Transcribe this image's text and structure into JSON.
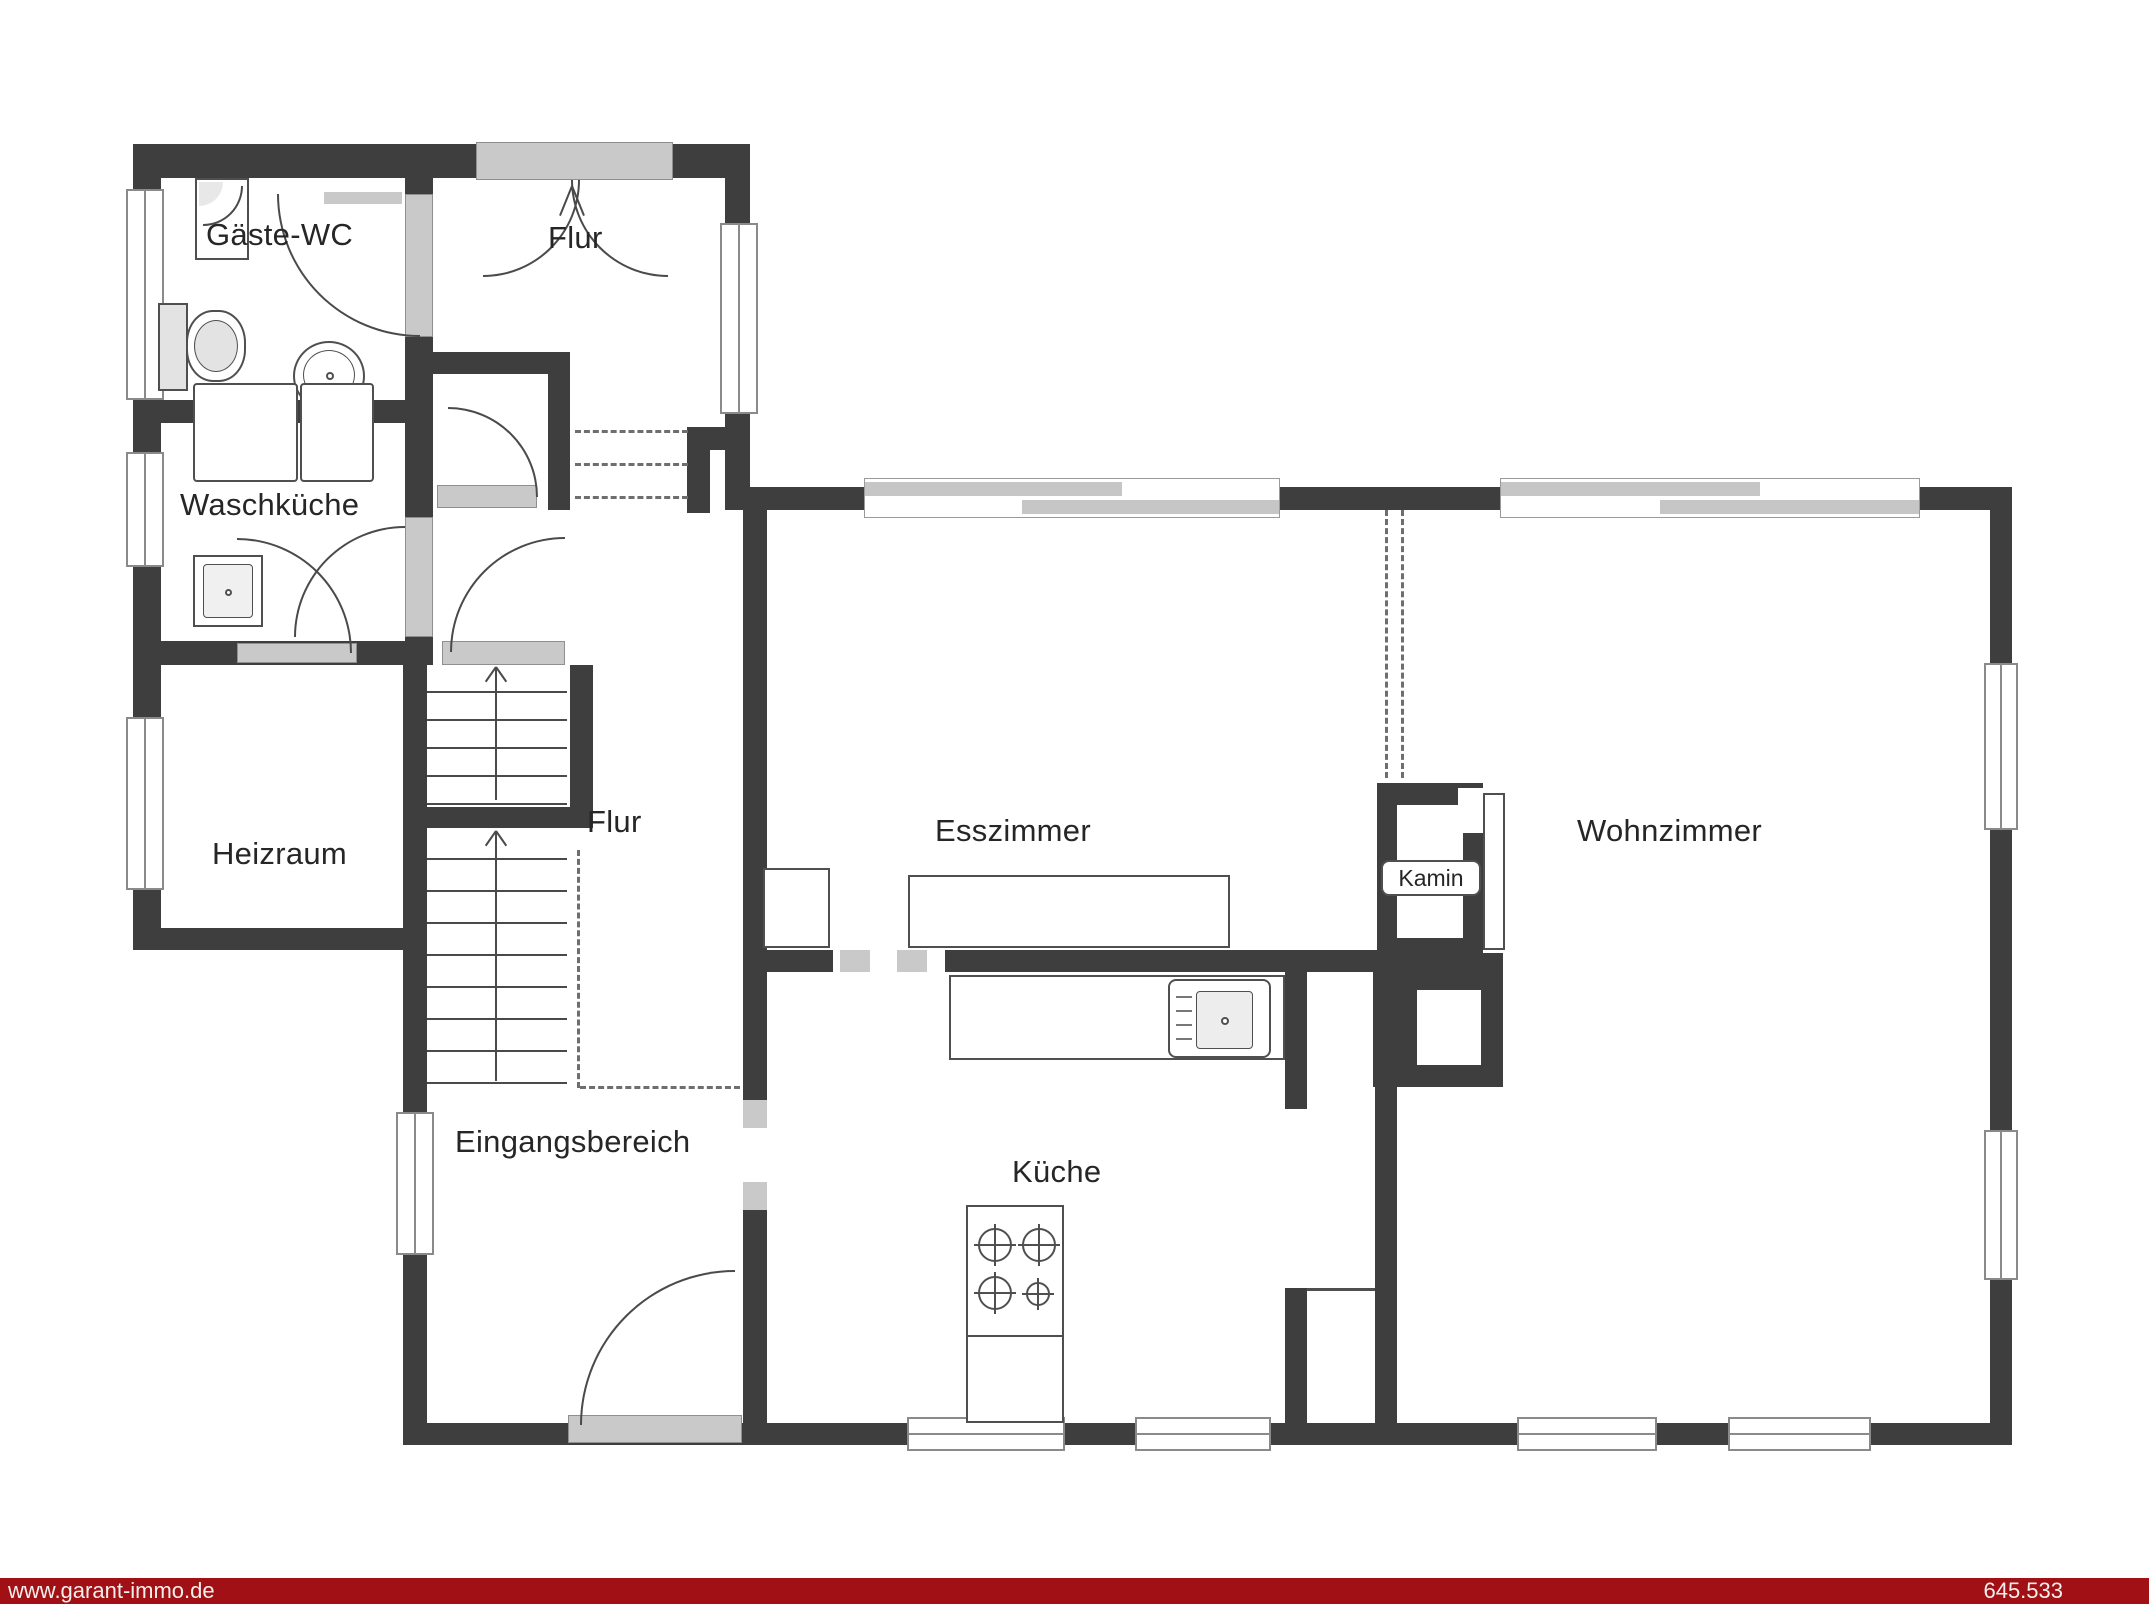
{
  "rooms": {
    "gaeste_wc": "Gäste-WC",
    "flur_top": "Flur",
    "waschkueche": "Waschküche",
    "heizraum": "Heizraum",
    "flur_mid": "Flur",
    "eingangsbereich": "Eingangsbereich",
    "esszimmer": "Esszimmer",
    "kamin": "Kamin",
    "wohnzimmer": "Wohnzimmer",
    "kueche": "Küche"
  },
  "footer": {
    "left": "www.garant-immo.de",
    "right": "645.533"
  },
  "colors": {
    "wall": "#3e3e3e",
    "window_fill": "#c9c9c9",
    "footer_bar": "#a01014"
  }
}
